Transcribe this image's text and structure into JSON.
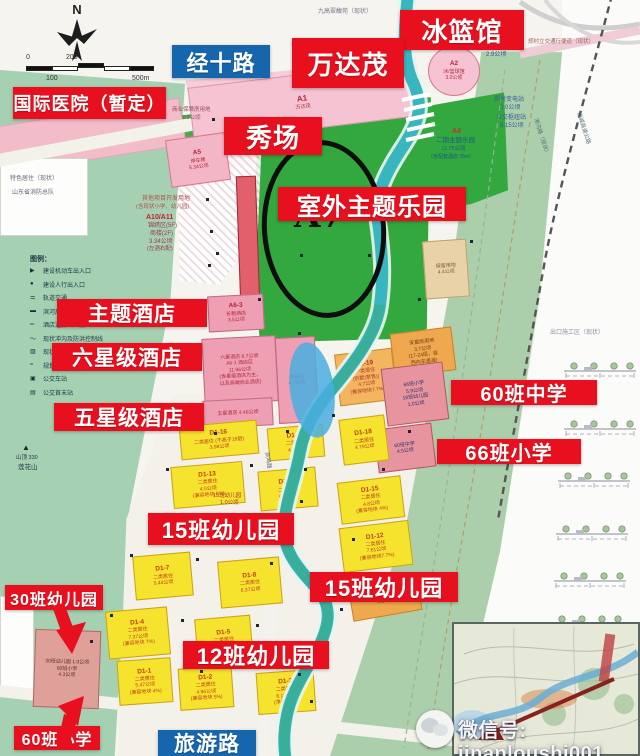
{
  "circle_label": "A7",
  "compass": {
    "north": "N"
  },
  "scale_bar": {
    "zero": "0",
    "two_hundred": "200",
    "one_hundred": "100",
    "five_hundred": "500m"
  },
  "watermark": {
    "text": "微信号: jinanloushi001"
  },
  "legend": {
    "title": "图例：",
    "items": [
      {
        "m": "▶",
        "t": "建设机动车出入口"
      },
      {
        "m": "●",
        "t": "建设人行出入口"
      },
      {
        "m": "⚌",
        "t": "轨道交通"
      },
      {
        "m": "▬",
        "t": "滨河展示带"
      },
      {
        "m": "═",
        "t": "酒店连廊（二层）"
      },
      {
        "m": "～",
        "t": "现状冲沟及防洪控制线"
      },
      {
        "m": "▨",
        "t": "现状滞洪池"
      },
      {
        "m": "≈",
        "t": "规划水系"
      },
      {
        "m": "▣",
        "t": "公交车站"
      },
      {
        "m": "▤",
        "t": "公交首末站"
      }
    ]
  },
  "callouts": [
    {
      "id": "bing-lan-guan",
      "text": "冰篮馆",
      "type": "red",
      "x": 400,
      "y": 10,
      "w": 124,
      "h": 40,
      "fs": 26
    },
    {
      "id": "wanda-mao",
      "text": "万达茂",
      "type": "red",
      "x": 292,
      "y": 38,
      "w": 112,
      "h": 50,
      "fs": 26
    },
    {
      "id": "jingshi-road",
      "text": "经十路",
      "type": "blue",
      "x": 172,
      "y": 45,
      "w": 98,
      "h": 33,
      "fs": 22
    },
    {
      "id": "intl-hospital",
      "text": "国际医院（暂定）",
      "type": "red",
      "x": 13,
      "y": 87,
      "w": 153,
      "h": 32,
      "fs": 18
    },
    {
      "id": "xiuchang",
      "text": "秀场",
      "type": "red",
      "x": 224,
      "y": 117,
      "w": 98,
      "h": 38,
      "fs": 26
    },
    {
      "id": "outdoor-theme-park",
      "text": "室外主题乐园",
      "type": "red",
      "x": 278,
      "y": 187,
      "w": 188,
      "h": 34,
      "fs": 24
    },
    {
      "id": "theme-hotel",
      "text": "主题酒店",
      "type": "red",
      "x": 57,
      "y": 299,
      "w": 150,
      "h": 28,
      "fs": 21
    },
    {
      "id": "six-star-hotel",
      "text": "六星级酒店",
      "type": "red",
      "x": 52,
      "y": 343,
      "w": 150,
      "h": 28,
      "fs": 21
    },
    {
      "id": "five-star-hotel",
      "text": "五星级酒店",
      "type": "red",
      "x": 54,
      "y": 403,
      "w": 150,
      "h": 28,
      "fs": 21
    },
    {
      "id": "school-60-middle",
      "text": "60班中学",
      "type": "red",
      "x": 451,
      "y": 380,
      "w": 146,
      "h": 25,
      "fs": 20
    },
    {
      "id": "school-66-primary",
      "text": "66班小学",
      "type": "red",
      "x": 437,
      "y": 439,
      "w": 144,
      "h": 25,
      "fs": 20
    },
    {
      "id": "kg-15-left",
      "text": "15班幼儿园",
      "type": "red",
      "x": 148,
      "y": 513,
      "w": 146,
      "h": 32,
      "fs": 22
    },
    {
      "id": "kg-15-right",
      "text": "15班幼儿园",
      "type": "red",
      "x": 310,
      "y": 572,
      "w": 148,
      "h": 30,
      "fs": 22
    },
    {
      "id": "kg-12",
      "text": "12班幼儿园",
      "type": "red",
      "x": 183,
      "y": 641,
      "w": 146,
      "h": 28,
      "fs": 22
    },
    {
      "id": "kg-30",
      "text": "30班幼儿园",
      "type": "red",
      "x": 5,
      "y": 585,
      "w": 98,
      "h": 25,
      "fs": 16
    },
    {
      "id": "school-60-primary",
      "text": "60班小学",
      "type": "red",
      "x": 14,
      "y": 726,
      "w": 86,
      "h": 24,
      "fs": 16
    },
    {
      "id": "tourism-road",
      "text": "旅游路",
      "type": "blue",
      "x": 158,
      "y": 730,
      "w": 98,
      "h": 26,
      "fs": 21
    }
  ],
  "blocks": [
    {
      "code": "A1",
      "lines": [
        "万达茂"
      ],
      "f": "#f5c3d2",
      "bd": "#d898b0",
      "tc": "#b02838",
      "x": 190,
      "y": 74,
      "w": 225,
      "h": 56,
      "r": -7,
      "cfs": 8
    },
    {
      "code": "A2",
      "lines": [
        "冰/篮球馆",
        "3.0公顷"
      ],
      "f": "#f5c3d2",
      "bd": "#d8788a",
      "tc": "#b02838",
      "x": 428,
      "y": 46,
      "w": 52,
      "h": 50,
      "r": 0,
      "round": 1
    },
    {
      "code": "A5",
      "lines": [
        "停车楼",
        "5.34公顷"
      ],
      "f": "#f2b6c6",
      "bd": "#d8788a",
      "tc": "#b02838",
      "x": 168,
      "y": 136,
      "w": 60,
      "h": 48,
      "r": -8
    },
    {
      "code": "",
      "lines": [],
      "f": "#e2606c",
      "bd": "#a02838",
      "tc": "#fff",
      "x": 238,
      "y": 176,
      "w": 20,
      "h": 126,
      "r": -2
    },
    {
      "code": "A6-3",
      "lines": [
        "长租酒店",
        "3.5公顷"
      ],
      "f": "#ef9fb4",
      "bd": "#c06a80",
      "tc": "#b02838",
      "x": 208,
      "y": 295,
      "w": 56,
      "h": 36,
      "r": -3
    },
    {
      "code": "",
      "lines": [
        "六星酒店 8.7公顷",
        "A6-1 酒店区",
        "11.96公顷",
        "(含星级酒店为主，",
        "以及高端商业酒店)"
      ],
      "f": "#ef9fb4",
      "bd": "#c06a80",
      "tc": "#b02838",
      "x": 203,
      "y": 337,
      "w": 74,
      "h": 66,
      "r": -3
    },
    {
      "code": "",
      "lines": [
        "五星酒店 4.46公顷"
      ],
      "f": "#ef9fb4",
      "bd": "#c06a80",
      "tc": "#b02838",
      "x": 203,
      "y": 399,
      "w": 70,
      "h": 28,
      "r": -3
    },
    {
      "code": "",
      "lines": [
        "酒店区",
        "4.7公顷"
      ],
      "f": "#ef9fb4",
      "bd": "#c06a80",
      "tc": "#b02838",
      "x": 277,
      "y": 337,
      "w": 40,
      "h": 86,
      "r": -3
    },
    {
      "code": "",
      "lines": [
        "保留用地",
        "4.4公顷"
      ],
      "f": "#ead2a8",
      "bd": "#bfa06a",
      "tc": "#7a5a2a",
      "x": 424,
      "y": 240,
      "w": 44,
      "h": 58,
      "r": -4
    },
    {
      "code": "",
      "lines": [
        "安置房用地",
        "3.7公顷",
        "(17-24层，自",
        "西向东递减)"
      ],
      "f": "#efa84e",
      "bd": "#c9812a",
      "tc": "#6d3d12",
      "x": 392,
      "y": 330,
      "w": 62,
      "h": 44,
      "r": -7
    },
    {
      "code": "D1-19",
      "lines": [
        "一类居住",
        "(别墅(禁售))",
        "4.7公顷",
        "(兼容地块7.7%)"
      ],
      "f": "#f3b55e",
      "bd": "#c98a2a",
      "tc": "#b03828",
      "x": 337,
      "y": 351,
      "w": 58,
      "h": 52,
      "r": -7
    },
    {
      "code": "",
      "lines": [
        "66班小学",
        "5.9公顷",
        "18班幼儿园",
        "1.0公顷"
      ],
      "f": "#e8949e",
      "bd": "#b85560",
      "tc": "#25356a",
      "x": 384,
      "y": 365,
      "w": 62,
      "h": 58,
      "r": -7
    },
    {
      "code": "",
      "lines": [
        "60班中学",
        "4.5公顷"
      ],
      "f": "#e8949e",
      "bd": "#b85560",
      "tc": "#25356a",
      "x": 376,
      "y": 426,
      "w": 58,
      "h": 44,
      "r": -7
    },
    {
      "code": "D1-18",
      "lines": [
        "二类居住",
        "4.79公顷"
      ],
      "f": "#f6e32e",
      "bd": "#caa31a",
      "tc": "#c04018",
      "x": 341,
      "y": 417,
      "w": 46,
      "h": 46,
      "r": -7
    },
    {
      "code": "D1-16",
      "lines": [
        "二类居住 (不高于18层)",
        "3.98公顷"
      ],
      "f": "#f6e32e",
      "bd": "#caa31a",
      "tc": "#c04018",
      "x": 180,
      "y": 423,
      "w": 78,
      "h": 34,
      "r": -5
    },
    {
      "code": "D1-17",
      "lines": [
        "二类居住",
        "4.5公顷"
      ],
      "f": "#f6e32e",
      "bd": "#caa31a",
      "tc": "#c04018",
      "x": 268,
      "y": 426,
      "w": 56,
      "h": 33,
      "r": -5
    },
    {
      "code": "D1-13",
      "lines": [
        "二类居住",
        "4.5公顷",
        "(兼容地块 5%)"
      ],
      "f": "#f6e32e",
      "bd": "#caa31a",
      "tc": "#c04018",
      "x": 172,
      "y": 464,
      "w": 72,
      "h": 42,
      "r": -5
    },
    {
      "code": "D1-14",
      "lines": [
        "二类居住",
        "4.76公顷"
      ],
      "f": "#f6e32e",
      "bd": "#caa31a",
      "tc": "#c04018",
      "x": 259,
      "y": 469,
      "w": 58,
      "h": 40,
      "r": -5
    },
    {
      "code": "D1-15",
      "lines": [
        "二类居住",
        "4.8公顷",
        "(兼容地块 4%)"
      ],
      "f": "#f6e32e",
      "bd": "#caa31a",
      "tc": "#c04018",
      "x": 339,
      "y": 479,
      "w": 64,
      "h": 42,
      "r": -7
    },
    {
      "code": "D1-12",
      "lines": [
        "二类居住",
        "7.61公顷",
        "(兼容地块7.7%)"
      ],
      "f": "#f6e32e",
      "bd": "#caa31a",
      "tc": "#c04018",
      "x": 341,
      "y": 524,
      "w": 70,
      "h": 45,
      "r": -7
    },
    {
      "code": "D1-7",
      "lines": [
        "二类居住",
        "5.44公顷"
      ],
      "f": "#f6e32e",
      "bd": "#caa31a",
      "tc": "#c04018",
      "x": 134,
      "y": 554,
      "w": 58,
      "h": 44,
      "r": -5
    },
    {
      "code": "D1-8",
      "lines": [
        "二类居住",
        "6.37公顷"
      ],
      "f": "#f6e32e",
      "bd": "#caa31a",
      "tc": "#c04018",
      "x": 219,
      "y": 559,
      "w": 62,
      "h": 47,
      "r": -5
    },
    {
      "code": "",
      "lines": [
        "安置房用地",
        "3.2公顷"
      ],
      "f": "#efa84e",
      "bd": "#c9812a",
      "tc": "#6d3d12",
      "x": 350,
      "y": 580,
      "w": 70,
      "h": 36,
      "r": -10
    },
    {
      "code": "D1-4",
      "lines": [
        "二类居住",
        "7.37公顷",
        "(兼容地块 7%)"
      ],
      "f": "#f6e32e",
      "bd": "#caa31a",
      "tc": "#c04018",
      "x": 107,
      "y": 609,
      "w": 62,
      "h": 48,
      "r": -5
    },
    {
      "code": "D1-5",
      "lines": [
        "二类居住",
        "4.8公顷"
      ],
      "f": "#f6e32e",
      "bd": "#caa31a",
      "tc": "#c04018",
      "x": 196,
      "y": 617,
      "w": 56,
      "h": 45,
      "r": -5
    },
    {
      "code": "",
      "lines": [
        "30班幼儿园 1.0公顷",
        "60班小学",
        "4.3公顷"
      ],
      "f": "#dfa09a",
      "bd": "#b06a60",
      "tc": "#5a2a2a",
      "x": 34,
      "y": 630,
      "w": 66,
      "h": 78,
      "r": 2
    },
    {
      "code": "D1-1",
      "lines": [
        "二类居住",
        "5.47公顷",
        "(兼容地块 4%)"
      ],
      "f": "#f6e32e",
      "bd": "#caa31a",
      "tc": "#c04018",
      "x": 118,
      "y": 659,
      "w": 54,
      "h": 45,
      "r": -4
    },
    {
      "code": "D1-2",
      "lines": [
        "二类居住",
        "4.96公顷",
        "(兼容地块 5%)"
      ],
      "f": "#f6e32e",
      "bd": "#caa31a",
      "tc": "#c04018",
      "x": 179,
      "y": 667,
      "w": 54,
      "h": 42,
      "r": -4
    },
    {
      "code": "D1-3",
      "lines": [
        "二类居住",
        "6.15公顷",
        "(净容地7.7)"
      ],
      "f": "#f6e32e",
      "bd": "#caa31a",
      "tc": "#c04018",
      "x": 257,
      "y": 671,
      "w": 58,
      "h": 42,
      "r": -4
    }
  ],
  "map_texts": [
    {
      "t": "九高翠馥苑（现状）",
      "x": 318,
      "y": 9,
      "fs": 6,
      "c": "#778"
    },
    {
      "t": "郑村立交通行便道（现状）",
      "x": 528,
      "y": 40,
      "fs": 5.5,
      "c": "#a06060"
    },
    {
      "t": "保障用地",
      "x": 483,
      "y": 44,
      "fs": 6,
      "c": "#335a9a"
    },
    {
      "t": "2.9公顷",
      "x": 486,
      "y": 52,
      "fs": 6,
      "c": "#335a9a"
    },
    {
      "t": "郑村变电站",
      "x": 494,
      "y": 97,
      "fs": 6,
      "c": "#335a9a"
    },
    {
      "t": "2.0公顷",
      "x": 500,
      "y": 105,
      "fs": 6,
      "c": "#335a9a"
    },
    {
      "t": "公交枢纽站",
      "x": 496,
      "y": 115,
      "fs": 6,
      "c": "#335a9a"
    },
    {
      "t": "6.15公顷",
      "x": 500,
      "y": 123,
      "fs": 6,
      "c": "#335a9a"
    },
    {
      "t": "A4",
      "x": 452,
      "y": 128,
      "fs": 7,
      "c": "#c03030",
      "b": 1
    },
    {
      "t": "二期主题乐园",
      "x": 436,
      "y": 138,
      "fs": 6.5,
      "c": "#1a5a8a"
    },
    {
      "t": "(2.75公顷",
      "x": 442,
      "y": 147,
      "fs": 5.5,
      "c": "#1a5a8a"
    },
    {
      "t": "（含配套酒店 35m）",
      "x": 428,
      "y": 155,
      "fs": 5,
      "c": "#1a5a8a"
    },
    {
      "t": "商业保障房用地",
      "x": 172,
      "y": 108,
      "fs": 5.5,
      "c": "#9a4a5a"
    },
    {
      "t": "7.1公顷",
      "x": 182,
      "y": 116,
      "fs": 5.5,
      "c": "#9a4a5a"
    },
    {
      "t": "其他项目开发用地",
      "x": 142,
      "y": 196,
      "fs": 6,
      "c": "#b05050"
    },
    {
      "t": "(含现状小学、幼儿园)",
      "x": 136,
      "y": 205,
      "fs": 5.5,
      "c": "#b05050"
    },
    {
      "t": "A10/A11",
      "x": 146,
      "y": 214,
      "fs": 7,
      "c": "#c02030",
      "b": 1
    },
    {
      "t": "锦绣区(5F)",
      "x": 148,
      "y": 223,
      "fs": 6,
      "c": "#9a3a4a"
    },
    {
      "t": "商楼(2F)",
      "x": 150,
      "y": 231,
      "fs": 6,
      "c": "#9a3a4a"
    },
    {
      "t": "3.34公顷",
      "x": 149,
      "y": 239,
      "fs": 6,
      "c": "#9a3a4a"
    },
    {
      "t": "(左酒右配)",
      "x": 147,
      "y": 247,
      "fs": 5.5,
      "c": "#9a3a4a"
    },
    {
      "t": "特色居住（现状）",
      "x": 10,
      "y": 176,
      "fs": 6,
      "c": "#667"
    },
    {
      "t": "山东省消防总队",
      "x": 12,
      "y": 190,
      "fs": 6,
      "c": "#667"
    },
    {
      "t": "▲",
      "x": 22,
      "y": 444,
      "fs": 8,
      "c": "#222"
    },
    {
      "t": "山顶 330",
      "x": 16,
      "y": 456,
      "fs": 5.5,
      "c": "#234"
    },
    {
      "t": "莲花山",
      "x": 18,
      "y": 465,
      "fs": 6.5,
      "c": "#234"
    },
    {
      "t": "出口施工区（现状）",
      "x": 550,
      "y": 330,
      "fs": 6,
      "c": "#8a95a0"
    },
    {
      "t": "15班幼儿园",
      "x": 213,
      "y": 494,
      "fs": 5.5,
      "c": "#b03030"
    },
    {
      "t": "1.0公顷",
      "x": 220,
      "y": 501,
      "fs": 5.5,
      "c": "#b03030"
    },
    {
      "t": "港沟路（现状）",
      "x": 537,
      "y": 118,
      "fs": 5.5,
      "c": "#56707a",
      "r": 72
    },
    {
      "t": "绕城高速公路",
      "x": 580,
      "y": 112,
      "fs": 5.5,
      "c": "#56707a",
      "r": 72
    },
    {
      "t": "凤鸣路",
      "x": 268,
      "y": 452,
      "fs": 5.5,
      "c": "#567",
      "r": 80
    }
  ],
  "dots": [
    [
      212,
      118
    ],
    [
      252,
      148
    ],
    [
      298,
      142
    ],
    [
      216,
      252
    ],
    [
      258,
      298
    ],
    [
      298,
      332
    ],
    [
      332,
      414
    ],
    [
      286,
      430
    ],
    [
      214,
      432
    ],
    [
      166,
      468
    ],
    [
      250,
      464
    ],
    [
      304,
      468
    ],
    [
      130,
      554
    ],
    [
      196,
      558
    ],
    [
      270,
      562
    ],
    [
      110,
      614
    ],
    [
      181,
      619
    ],
    [
      256,
      624
    ],
    [
      298,
      673
    ],
    [
      200,
      670
    ],
    [
      352,
      538
    ],
    [
      382,
      468
    ],
    [
      408,
      430
    ],
    [
      340,
      608
    ],
    [
      300,
      254
    ],
    [
      368,
      254
    ],
    [
      418,
      298
    ],
    [
      206,
      198
    ],
    [
      210,
      230
    ],
    [
      208,
      264
    ],
    [
      455,
      200
    ],
    [
      470,
      240
    ],
    [
      300,
      500
    ],
    [
      240,
      520
    ],
    [
      160,
      520
    ],
    [
      90,
      640
    ],
    [
      310,
      700
    ]
  ]
}
